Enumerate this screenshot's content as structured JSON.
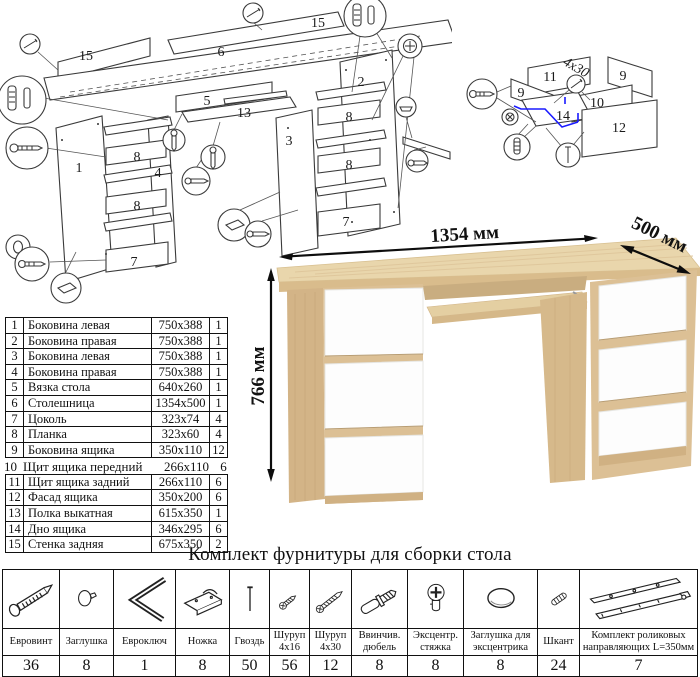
{
  "parts_table": {
    "rows": [
      {
        "num": "1",
        "name": "Боковина левая",
        "size": "750x388",
        "qty": "1"
      },
      {
        "num": "2",
        "name": "Боковина правая",
        "size": "750x388",
        "qty": "1"
      },
      {
        "num": "3",
        "name": "Боковина левая",
        "size": "750x388",
        "qty": "1"
      },
      {
        "num": "4",
        "name": "Боковина правая",
        "size": "750x388",
        "qty": "1"
      },
      {
        "num": "5",
        "name": "Вязка стола",
        "size": "640x260",
        "qty": "1"
      },
      {
        "num": "6",
        "name": "Столешница",
        "size": "1354x500",
        "qty": "1"
      },
      {
        "num": "7",
        "name": "Цоколь",
        "size": "323x74",
        "qty": "4"
      },
      {
        "num": "8",
        "name": "Планка",
        "size": "323x60",
        "qty": "4"
      },
      {
        "num": "9",
        "name": "Боковина ящика",
        "size": "350x110",
        "qty": "12"
      },
      {
        "num": "10",
        "name": "Щит ящика передний",
        "size": "266x110",
        "qty": "6"
      },
      {
        "num": "11",
        "name": "Щит ящика задний",
        "size": "266x110",
        "qty": "6"
      },
      {
        "num": "12",
        "name": "Фасад ящика",
        "size": "350x200",
        "qty": "6"
      },
      {
        "num": "13",
        "name": "Полка выкатная",
        "size": "615x350",
        "qty": "1"
      },
      {
        "num": "14",
        "name": "Дно ящика",
        "size": "346x295",
        "qty": "6"
      },
      {
        "num": "15",
        "name": "Стенка задняя",
        "size": "675x350",
        "qty": "2"
      }
    ]
  },
  "dimensions": {
    "width": "1354 мм",
    "depth": "500 мм",
    "height": "766 мм"
  },
  "hardware": {
    "title": "Комплект фурнитуры для сборки стола",
    "items": [
      {
        "name": "Евровинт",
        "qty": "36",
        "icon": "euro-screw-icon"
      },
      {
        "name": "Заглушка",
        "qty": "8",
        "icon": "cap-icon"
      },
      {
        "name": "Евроключ",
        "qty": "1",
        "icon": "hex-key-icon"
      },
      {
        "name": "Ножка",
        "qty": "8",
        "icon": "foot-icon"
      },
      {
        "name": "Гвоздь",
        "qty": "50",
        "icon": "nail-icon"
      },
      {
        "name": "Шуруп 4x16",
        "qty": "56",
        "icon": "screw-short-icon"
      },
      {
        "name": "Шуруп 4x30",
        "qty": "12",
        "icon": "screw-long-icon"
      },
      {
        "name": "Ввинчив. дюбель",
        "qty": "8",
        "icon": "dowel-screw-icon"
      },
      {
        "name": "Эксцентр. стяжка",
        "qty": "8",
        "icon": "cam-lock-icon"
      },
      {
        "name": "Заглушка для эксцентрика",
        "qty": "8",
        "icon": "cam-cover-icon"
      },
      {
        "name": "Шкант",
        "qty": "24",
        "icon": "wood-dowel-icon"
      },
      {
        "name": "Комплект роликовых направляющих L=350мм",
        "qty": "7",
        "icon": "roller-guides-icon"
      }
    ]
  },
  "diagram_main": {
    "labels": [
      "15",
      "15",
      "6",
      "5",
      "13",
      "1",
      "4",
      "8",
      "8",
      "7",
      "2",
      "3",
      "8",
      "8",
      "7"
    ]
  },
  "diagram_drawer": {
    "labels": [
      "11",
      "9",
      "9",
      "10",
      "14",
      "12"
    ],
    "screw_note": "4x30"
  },
  "colors": {
    "oak": "#dcc095",
    "oak_light": "#e9d6ac",
    "oak_dark": "#c9ad80",
    "drawer_white": "#fdfdfd",
    "highlight_blue": "#1a1aff",
    "line_black": "#111111"
  }
}
